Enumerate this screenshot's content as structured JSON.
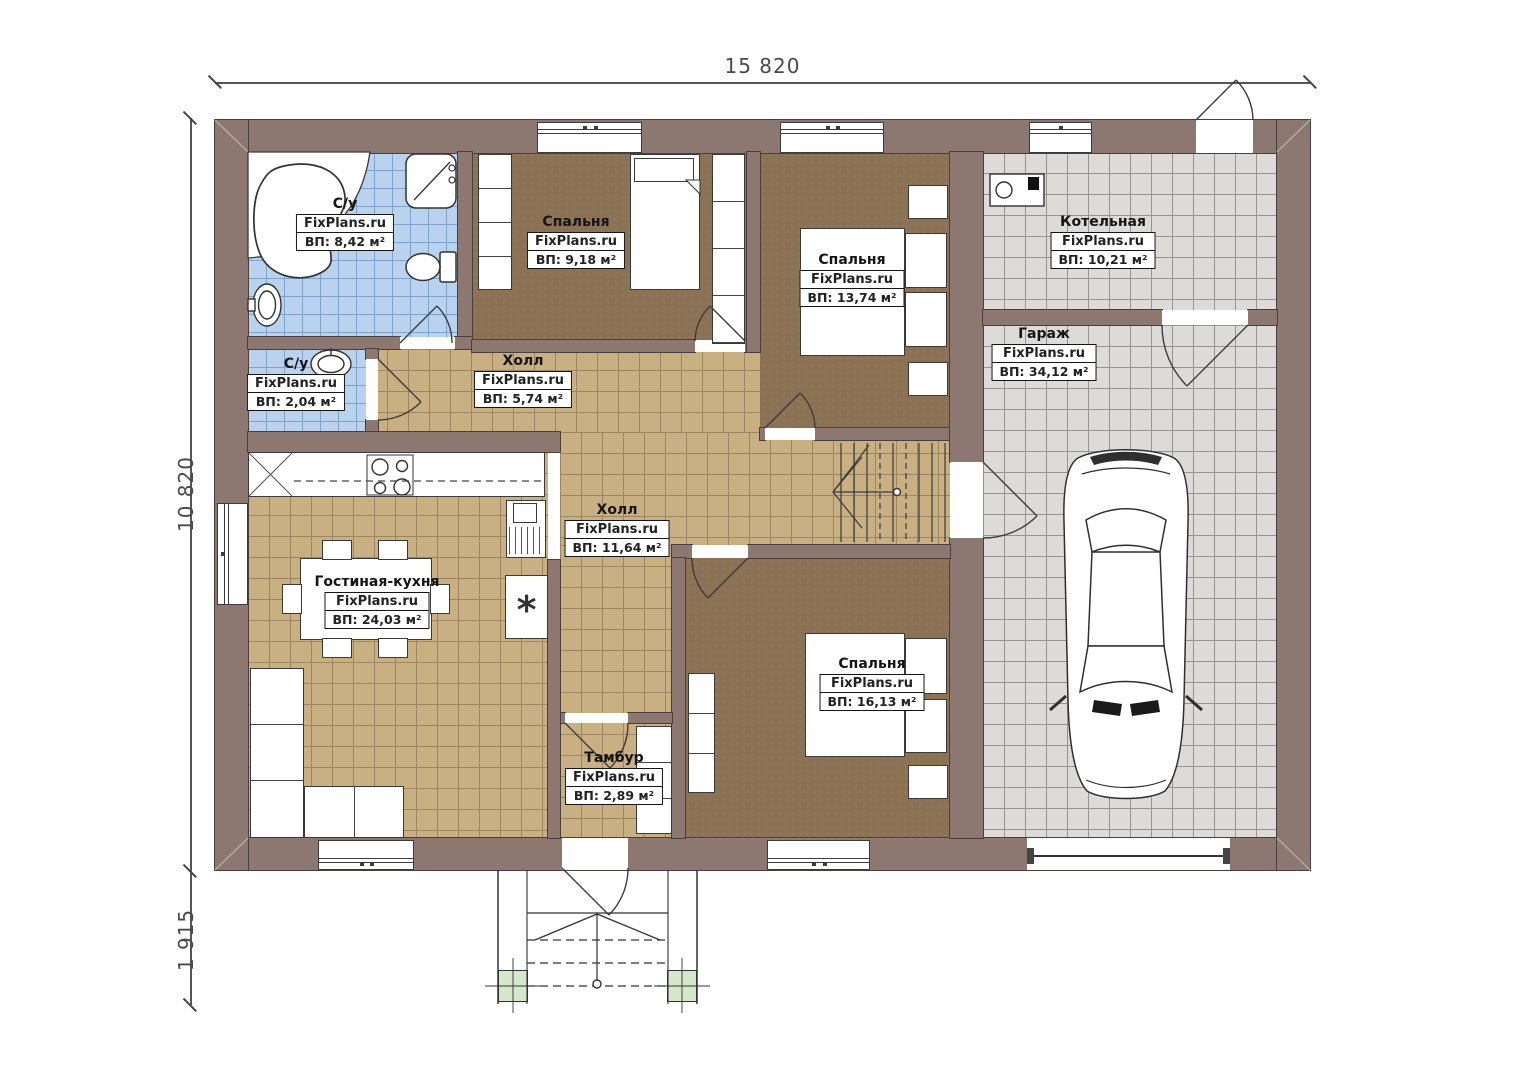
{
  "dimensions": {
    "top": "15 820",
    "left": "10 820",
    "bottom_left": "1 915"
  },
  "watermark": "FixPlans.ru",
  "rooms": [
    {
      "name": "С/у",
      "area": "ВП: 8,42 м²"
    },
    {
      "name": "Спальня",
      "area": "ВП: 9,18 м²"
    },
    {
      "name": "Спальня",
      "area": "ВП: 13,74 м²"
    },
    {
      "name": "Котельная",
      "area": "ВП: 10,21 м²"
    },
    {
      "name": "Гараж",
      "area": "ВП: 34,12 м²"
    },
    {
      "name": "С/у",
      "area": "ВП: 2,04 м²"
    },
    {
      "name": "Холл",
      "area": "ВП: 5,74 м²"
    },
    {
      "name": "Холл",
      "area": "ВП: 11,64 м²"
    },
    {
      "name": "Гостиная-кухня",
      "area": "ВП: 24,03 м²"
    },
    {
      "name": "Спальня",
      "area": "ВП: 16,13 м²"
    },
    {
      "name": "Тамбур",
      "area": "ВП: 2,89 м²"
    }
  ],
  "icons": {
    "fridge_glyph": "*"
  },
  "colors": {
    "wall": "#8d7771",
    "floor_blue": "#b9d3ef",
    "floor_tan": "#c9b083",
    "floor_gray": "#dcdbd8",
    "floor_brown": "#8b7254",
    "column_green": "#d5e8cb"
  }
}
